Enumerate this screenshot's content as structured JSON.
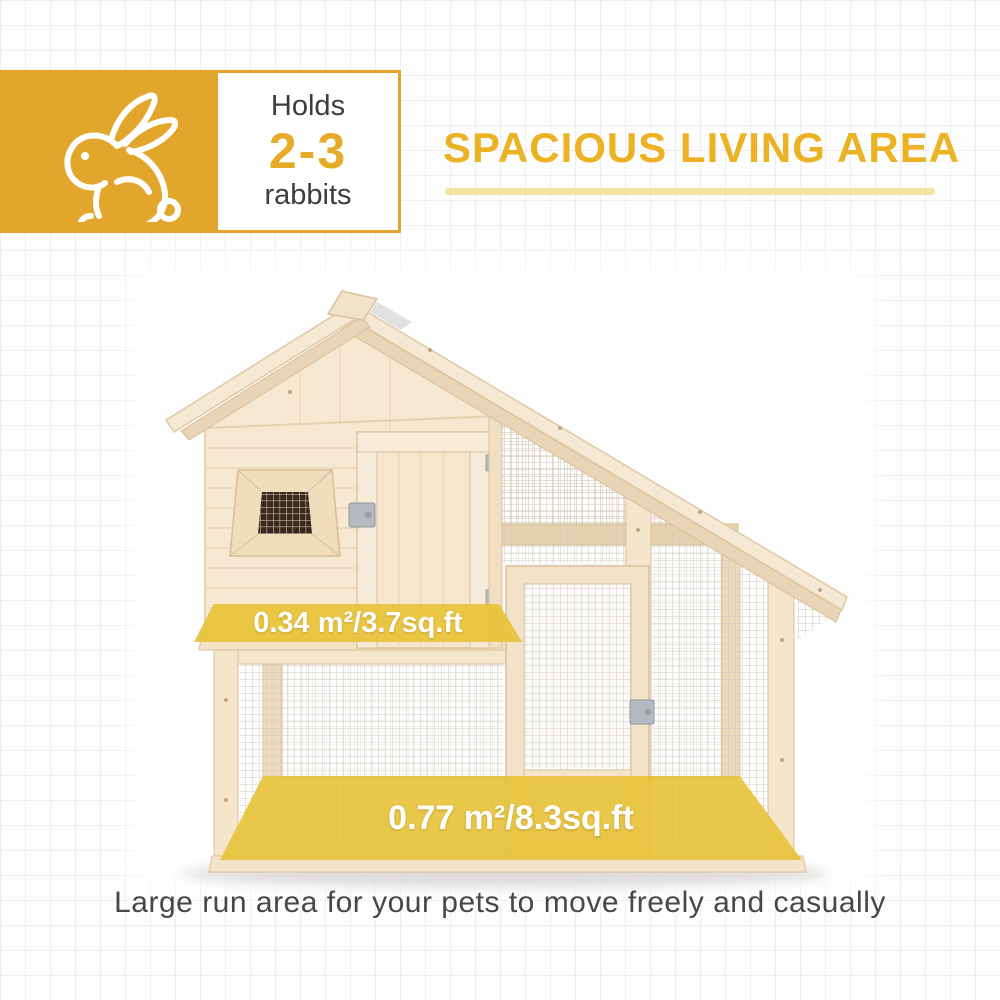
{
  "badge": {
    "icon": "rabbit-icon",
    "holds_label": "Holds",
    "count": "2-3",
    "unit_label": "rabbits"
  },
  "title": "SPACIOUS LIVING AREA",
  "overlays": {
    "upper_area": "0.34 m²/3.7sq.ft",
    "lower_area": "0.77 m²/8.3sq.ft"
  },
  "caption": "Large run area for your pets to move freely and casually",
  "colors": {
    "accent_gold": "#e1a62b",
    "title_gold": "#ebb224",
    "underline_yellow": "#f6e2a2",
    "overlay_yellow": "#e8c33a",
    "wood_light": "#f6e8d1",
    "wood_dark": "#e9d5b5",
    "text_dark": "#3d3d3d"
  }
}
